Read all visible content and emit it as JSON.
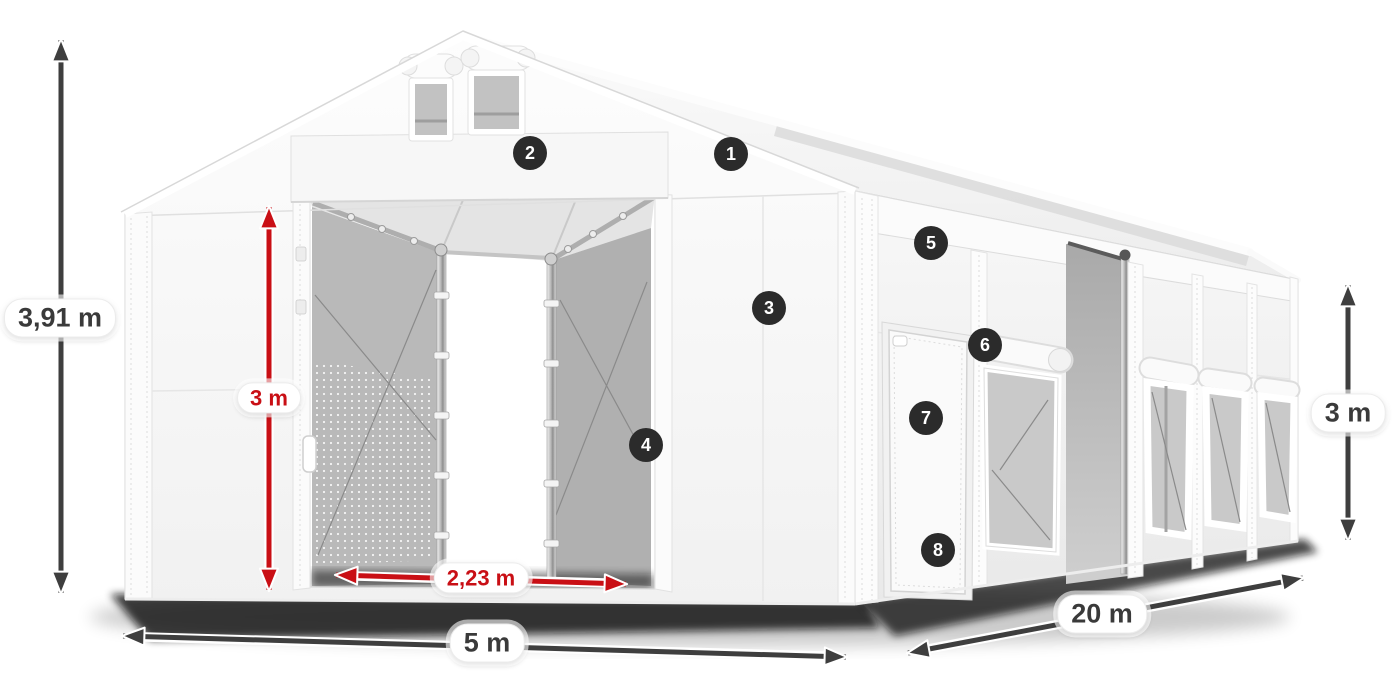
{
  "colors": {
    "accent-red": "#c90f15",
    "arrow-dark": "#3e3e3e",
    "badge-bg": "#2b2b2b",
    "label-dark": "#3a3a3a"
  },
  "measurements": {
    "total_height": {
      "label": "3,91 m",
      "color": "dark"
    },
    "door_height": {
      "label": "3 m",
      "color": "red"
    },
    "door_width": {
      "label": "2,23 m",
      "color": "red"
    },
    "front_width": {
      "label": "5 m",
      "color": "dark"
    },
    "length": {
      "label": "20 m",
      "color": "dark"
    },
    "side_height": {
      "label": "3 m",
      "color": "dark"
    }
  },
  "feature_badges": [
    "1",
    "2",
    "3",
    "4",
    "5",
    "6",
    "7",
    "8"
  ]
}
